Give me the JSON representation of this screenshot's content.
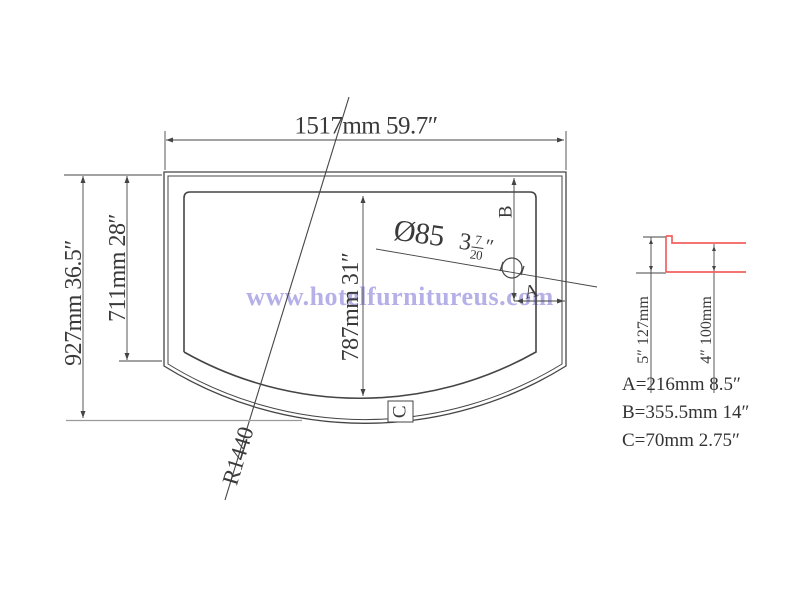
{
  "watermark": "www.hotelfurnitureus.com",
  "colors": {
    "profile_red": "#f2615f",
    "watermark": "#b5b0e8",
    "line_dark": "#454545",
    "line_gray": "#9a9a9a"
  },
  "plan": {
    "width_label": "1517mm 59.7″",
    "outer_height_label": "927mm 36.5″",
    "inner_height_label": "711mm 28″",
    "basin_length_label": "787mm 31″",
    "radius_label": "R1440",
    "drain": {
      "diameter": "Ø85",
      "whole": "3",
      "num": "7",
      "den": "20",
      "unit": "″"
    },
    "point_a": "A",
    "point_b": "B",
    "point_c": "C"
  },
  "section_detail": {
    "outer_height_label": "5″ 127mm",
    "inner_height_label": "4″ 100mm"
  },
  "legend": {
    "a": "A=216mm 8.5″",
    "b": "B=355.5mm 14″",
    "c": "C=70mm 2.75″"
  }
}
